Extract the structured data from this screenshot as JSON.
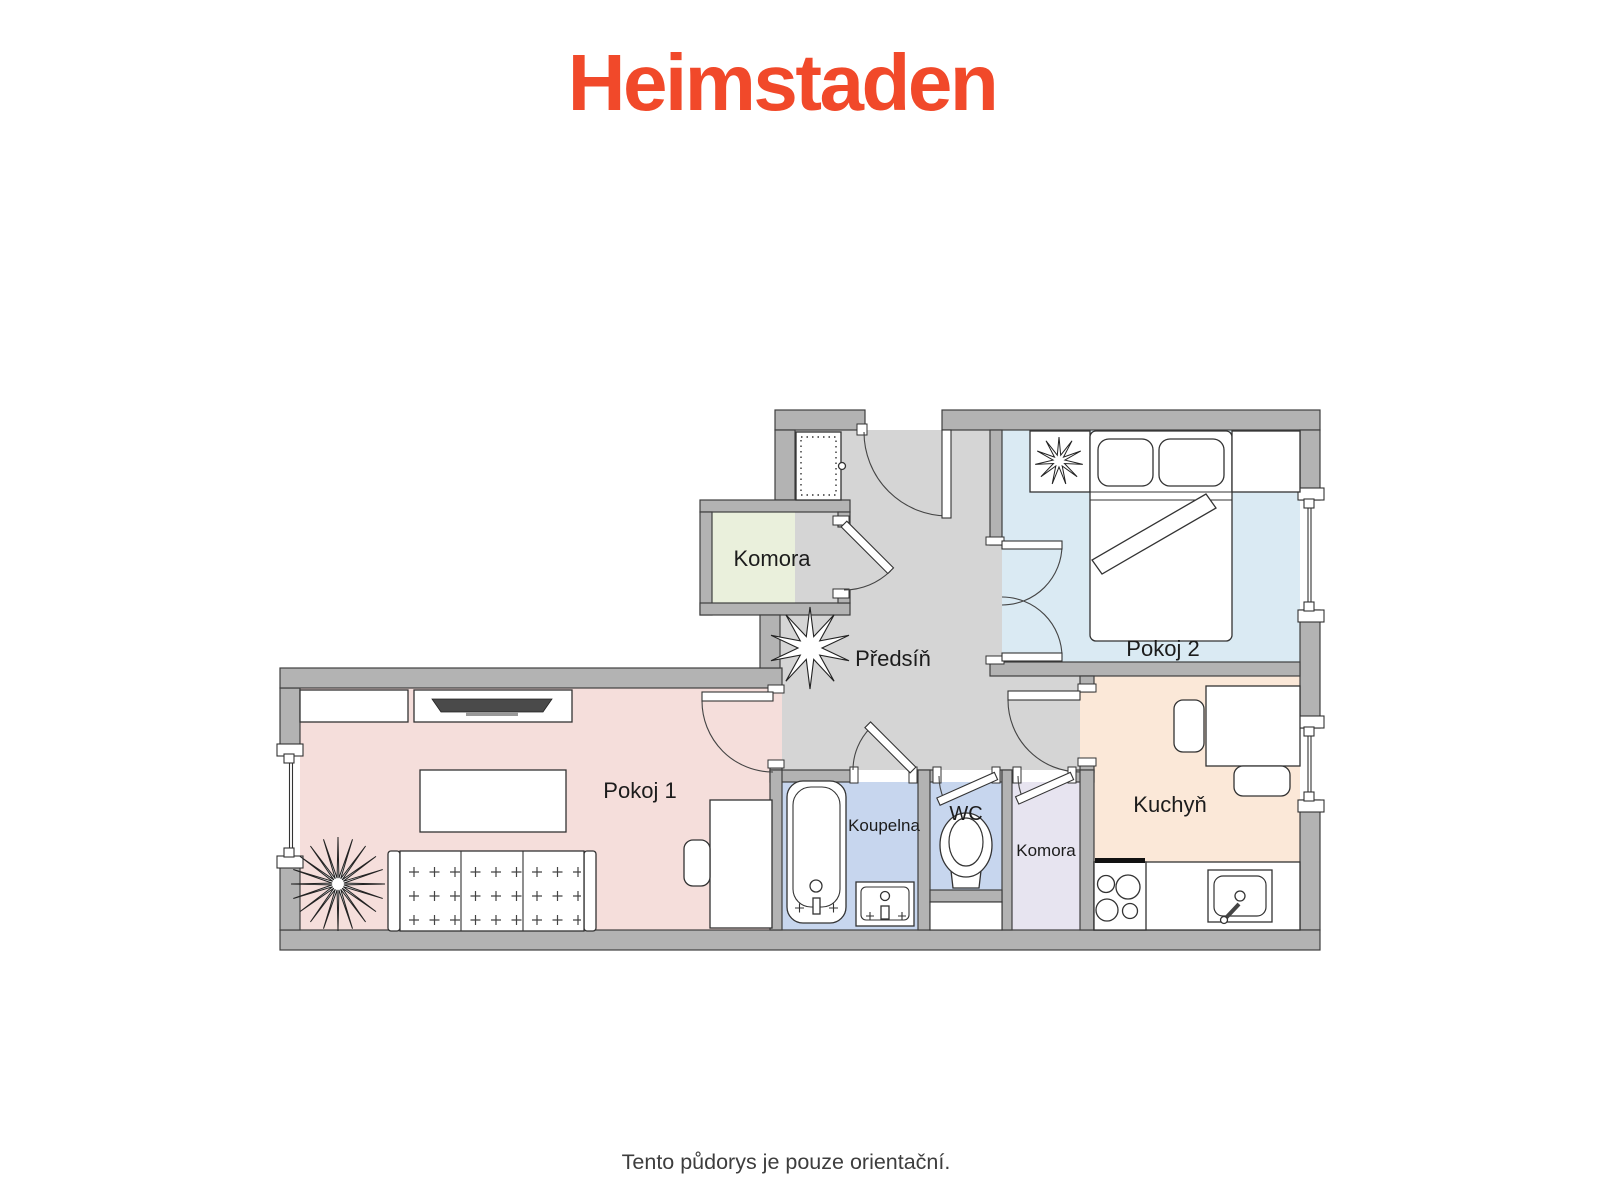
{
  "brand": {
    "name": "Heimstaden",
    "color": "#f1492a"
  },
  "disclaimer": "Tento půdorys je pouze orientační.",
  "floorplan": {
    "wall_color": "#b3b3b3",
    "hall_color": "#d5d5d5",
    "rooms": [
      {
        "id": "komora-1",
        "label": "Komora",
        "floor_color": "#eaf0dc"
      },
      {
        "id": "predsin",
        "label": "Předsíň",
        "floor_color": "#d5d5d5"
      },
      {
        "id": "pokoj-2",
        "label": "Pokoj 2",
        "floor_color": "#daeaf3"
      },
      {
        "id": "kuchyn",
        "label": "Kuchyň",
        "floor_color": "#fbe8d8"
      },
      {
        "id": "pokoj-1",
        "label": "Pokoj 1",
        "floor_color": "#f5dedb"
      },
      {
        "id": "koupelna",
        "label": "Koupelna",
        "floor_color": "#c7d6ee"
      },
      {
        "id": "wc",
        "label": "WC",
        "floor_color": "#c7d6ee"
      },
      {
        "id": "komora-2",
        "label": "Komora",
        "floor_color": "#e7e4f0"
      }
    ],
    "furniture": [
      "wardrobe",
      "coat-plant",
      "bed",
      "pillows",
      "nightstand",
      "plant-table",
      "double-door",
      "sofa",
      "coffee-table",
      "tv",
      "tv-stand",
      "wall-shelf",
      "desk",
      "desk-chair",
      "floor-plant",
      "bathtub",
      "washbasin",
      "toilet",
      "dining-table",
      "dining-chairs",
      "stove",
      "kitchen-sink",
      "kitchen-counter"
    ]
  }
}
